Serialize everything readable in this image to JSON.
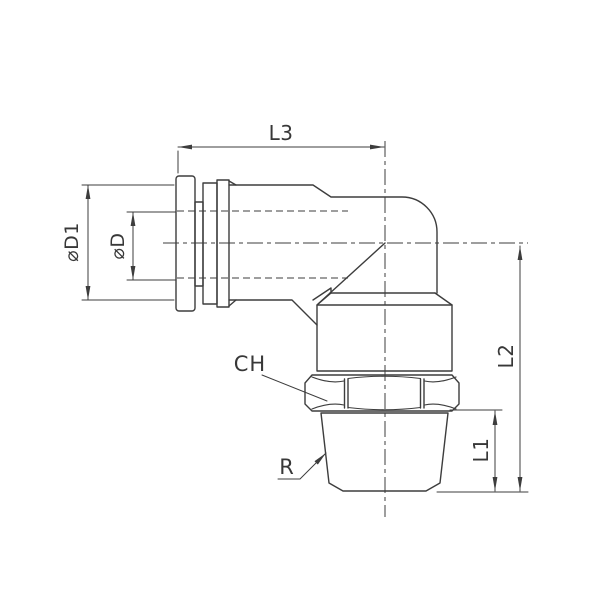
{
  "drawing": {
    "background_color": "#ffffff",
    "line_color": "#3d3d3d",
    "labels": {
      "length_l3": "L3",
      "diameter_d1": "⌀D1",
      "diameter_d": "⌀D",
      "length_l2": "L2",
      "length_l1": "L1",
      "hex_width": "CH",
      "thread": "R"
    }
  }
}
